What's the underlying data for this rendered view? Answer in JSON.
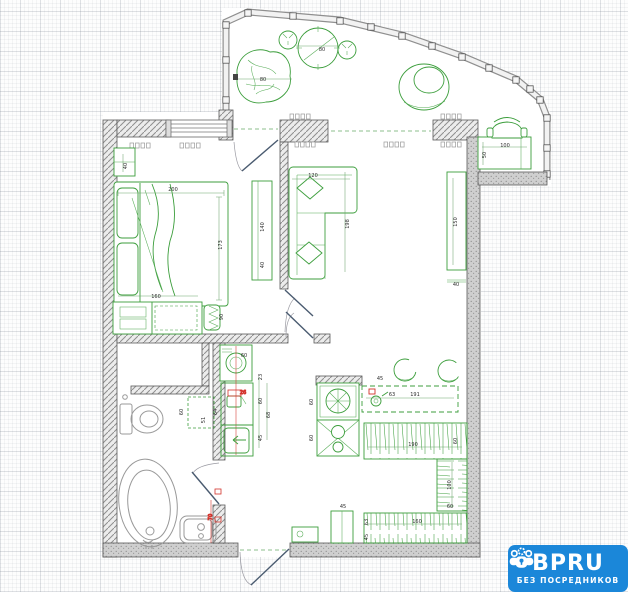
{
  "watermark": {
    "brand": "BPRU",
    "tagline": "БЕЗ ПОСРЕДНИКОВ",
    "bg_color": "#1b87d9",
    "text_color": "#ffffff",
    "icon": "people-group-lock-icon"
  },
  "colors": {
    "furniture_green": "#3c9e3c",
    "fixture_gray": "#9a9a9a",
    "wall_fill": "#ececec",
    "wall_dark": "#c9c9c9",
    "dimension_text": "#2d2d2d",
    "accent_red": "#d3322b",
    "door_leaf": "#4a5b70"
  },
  "furniture_icons": [
    "bed",
    "nightstand",
    "tv-stand",
    "dresser",
    "stool",
    "shelf-chevrons",
    "corner-sofa",
    "wall-cabinet",
    "plant-blob",
    "round-table",
    "balcony-chair-left",
    "balcony-chair-right",
    "papasan-chair",
    "desk",
    "desk-chair",
    "radiator",
    "kitchen-hob",
    "kitchen-sink-unit",
    "kitchen-counter",
    "counter-sink",
    "bar-chair",
    "wardrobe-rail",
    "entry-mat",
    "shoe-box",
    "washing-machine",
    "utility-chair",
    "utility-sink",
    "laundry-box-dashed",
    "toilet",
    "oval-bathtub",
    "small-bathtub",
    "window",
    "balcony-glazing",
    "door-swing"
  ],
  "dimensions": [
    {
      "v": "80",
      "x": 263,
      "y": 81
    },
    {
      "v": "80",
      "x": 322,
      "y": 51
    },
    {
      "v": "100",
      "x": 505,
      "y": 147
    },
    {
      "v": "50",
      "x": 486,
      "y": 155,
      "r": -90
    },
    {
      "v": "40",
      "x": 127,
      "y": 166,
      "r": -90
    },
    {
      "v": "200",
      "x": 173,
      "y": 191
    },
    {
      "v": "173",
      "x": 222,
      "y": 245,
      "r": -90
    },
    {
      "v": "140",
      "x": 264,
      "y": 227,
      "r": -90
    },
    {
      "v": "40",
      "x": 264,
      "y": 265,
      "r": -90
    },
    {
      "v": "160",
      "x": 156,
      "y": 298
    },
    {
      "v": "90",
      "x": 223,
      "y": 317,
      "r": -90
    },
    {
      "v": "120",
      "x": 313,
      "y": 177
    },
    {
      "v": "198",
      "x": 349,
      "y": 224,
      "r": -90
    },
    {
      "v": "150",
      "x": 457,
      "y": 222,
      "r": -90
    },
    {
      "v": "40",
      "x": 456,
      "y": 286
    },
    {
      "v": "60",
      "x": 313,
      "y": 402,
      "r": -90
    },
    {
      "v": "60",
      "x": 313,
      "y": 438,
      "r": -90
    },
    {
      "v": "45",
      "x": 380,
      "y": 380
    },
    {
      "v": "63",
      "x": 392,
      "y": 396
    },
    {
      "v": "191",
      "x": 415,
      "y": 396
    },
    {
      "v": "60",
      "x": 244,
      "y": 357
    },
    {
      "v": "26",
      "x": 243,
      "y": 394,
      "red": true
    },
    {
      "v": "23",
      "x": 262,
      "y": 377,
      "r": -90
    },
    {
      "v": "60",
      "x": 262,
      "y": 401,
      "r": -90
    },
    {
      "v": "45",
      "x": 262,
      "y": 438,
      "r": -90
    },
    {
      "v": "68",
      "x": 270,
      "y": 415,
      "r": -90
    },
    {
      "v": "60",
      "x": 183,
      "y": 412,
      "r": -90
    },
    {
      "v": "64",
      "x": 217,
      "y": 412,
      "r": -90
    },
    {
      "v": "51",
      "x": 205,
      "y": 420,
      "r": -90
    },
    {
      "v": "190",
      "x": 413,
      "y": 446
    },
    {
      "v": "60",
      "x": 457,
      "y": 441,
      "r": -90
    },
    {
      "v": "100",
      "x": 451,
      "y": 485,
      "r": -90
    },
    {
      "v": "60",
      "x": 450,
      "y": 508
    },
    {
      "v": "160",
      "x": 417,
      "y": 523
    },
    {
      "v": "63",
      "x": 368,
      "y": 522,
      "r": -90
    },
    {
      "v": "45",
      "x": 368,
      "y": 537,
      "r": -90
    },
    {
      "v": "45",
      "x": 343,
      "y": 508
    },
    {
      "v": "70",
      "x": 212,
      "y": 517,
      "r": -90,
      "red": true
    }
  ]
}
